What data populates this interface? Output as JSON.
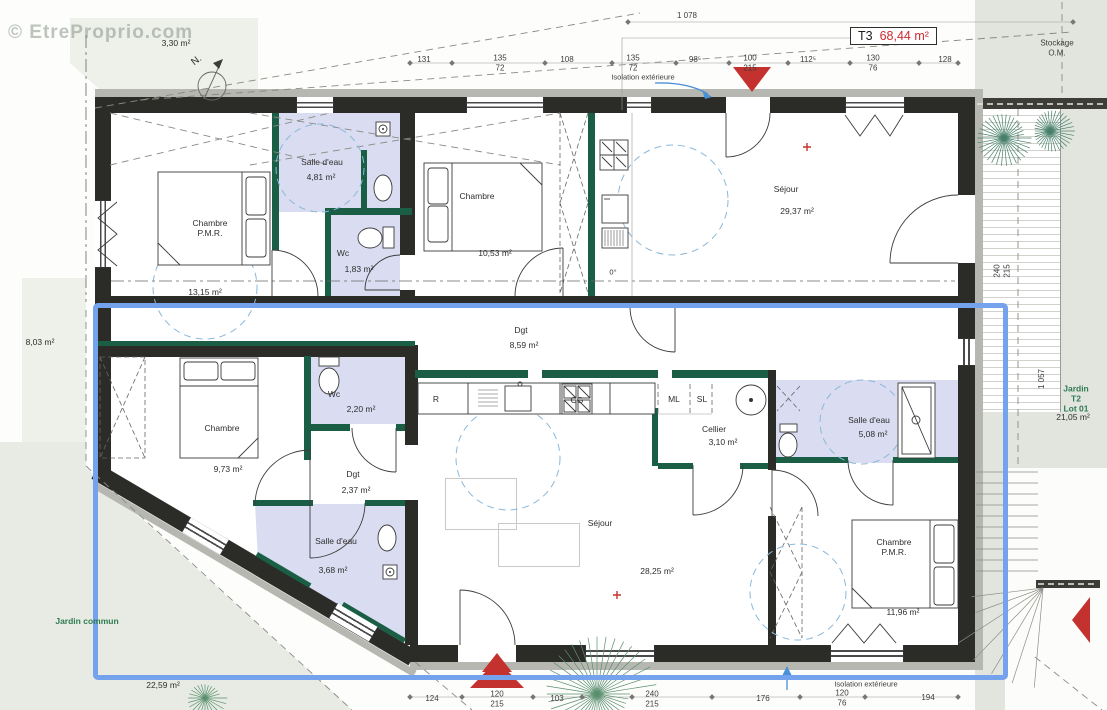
{
  "watermark": "© EtreProprio.com",
  "title_box": {
    "unit_type": "T3",
    "unit_area": "68,44 m²"
  },
  "compass": {
    "north_label": "N."
  },
  "outdoor": {
    "stockage": "Stockage O.M.",
    "isolation_top": "Isolation extérieure",
    "isolation_bottom": "Isolation extérieure",
    "area_top_left": "3,30 m²",
    "area_left": "8,03 m²",
    "jardin_commun": "Jardin commun",
    "jardin_commun_area": "22,59 m²",
    "jardin_t2": "Jardin T2\nLot 01",
    "jardin_t2_area": "21,05 m²"
  },
  "rooms": [
    {
      "name": "Chambre\nP.M.R.",
      "area": "13,15 m²"
    },
    {
      "name": "Salle d'eau",
      "area": "4,81 m²"
    },
    {
      "name": "Wc",
      "area": "1,83 m²"
    },
    {
      "name": "Chambre",
      "area": "10,53 m²"
    },
    {
      "name": "Séjour",
      "area": "29,37 m²"
    },
    {
      "name": "Dgt",
      "area": "8,59 m²"
    },
    {
      "name": "Chambre",
      "area": "9,73 m²"
    },
    {
      "name": "Wc",
      "area": "2,20 m²"
    },
    {
      "name": "Dgt",
      "area": "2,37 m²"
    },
    {
      "name": "Salle d'eau",
      "area": "3,68 m²"
    },
    {
      "name": "Séjour",
      "area": "28,25 m²"
    },
    {
      "name": "Cellier",
      "area": "3,10 m²"
    },
    {
      "name": "Salle d'eau",
      "area": "5,08 m²"
    },
    {
      "name": "Chambre\nP.M.R.",
      "area": "11,96 m²"
    }
  ],
  "appliances": {
    "fridge": "R",
    "hob": "CG",
    "washing_machine": "ML",
    "dryer": "SL",
    "freezer_temp": "0°"
  },
  "dimensions": {
    "overall_top": "1 078",
    "top": [
      "131",
      "135\n72",
      "108",
      "135\n72",
      "98⁵",
      "100\n215",
      "112⁵",
      "130\n76",
      "128"
    ],
    "bottom": [
      "124",
      "120\n215",
      "103",
      "240\n215",
      "176",
      "120\n76",
      "194"
    ],
    "right_upper": "240\n215",
    "right_lower": "1 057"
  },
  "colors": {
    "wall": "#2b2b28",
    "partition_green": "#1a5f45",
    "wet_room_fill": "#dadcf1",
    "unit_outline_blue": "#74a2ec",
    "marker_red": "#c4322f",
    "garden_label_green": "#2f7a52",
    "pmr_circle_blue": "#8ab8da"
  }
}
